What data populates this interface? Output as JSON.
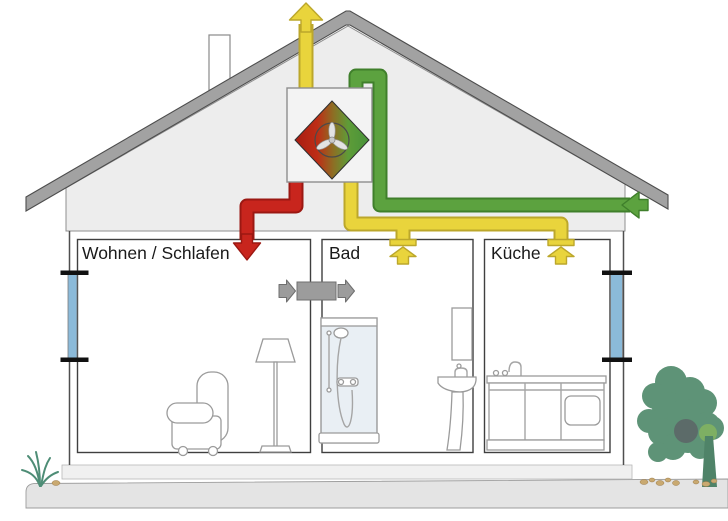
{
  "diagram": {
    "rooms": [
      {
        "label": "Wohnen / Schlafen"
      },
      {
        "label": "Bad"
      },
      {
        "label": "Küche"
      }
    ],
    "colors": {
      "extract_air_yellow": "#E9D43C",
      "extract_air_yellow_border": "#BCA72B",
      "fresh_air_green": "#5CA23F",
      "fresh_air_green_border": "#3F7F2B",
      "supply_air_red": "#C8251D",
      "supply_air_red_border": "#9B1812",
      "transfer_air_gray": "#9C9C9C",
      "roof_gray": "#A2A2A2",
      "wall_gray": "#EDEDED",
      "window_blue": "#8BBAD9",
      "heat_exchanger_red": "#A81C12",
      "heat_exchanger_green": "#47923A",
      "tree_green": "#5E9377",
      "ground_gray": "#E4E4E4"
    },
    "icons": [
      "exhaust-air-up-arrow",
      "fresh-air-inlet-arrow",
      "supply-air-down-arrow",
      "extract-air-up-arrow-bad",
      "extract-air-up-arrow-kueche",
      "transfer-air-arrows",
      "heat-exchanger-fan"
    ]
  }
}
